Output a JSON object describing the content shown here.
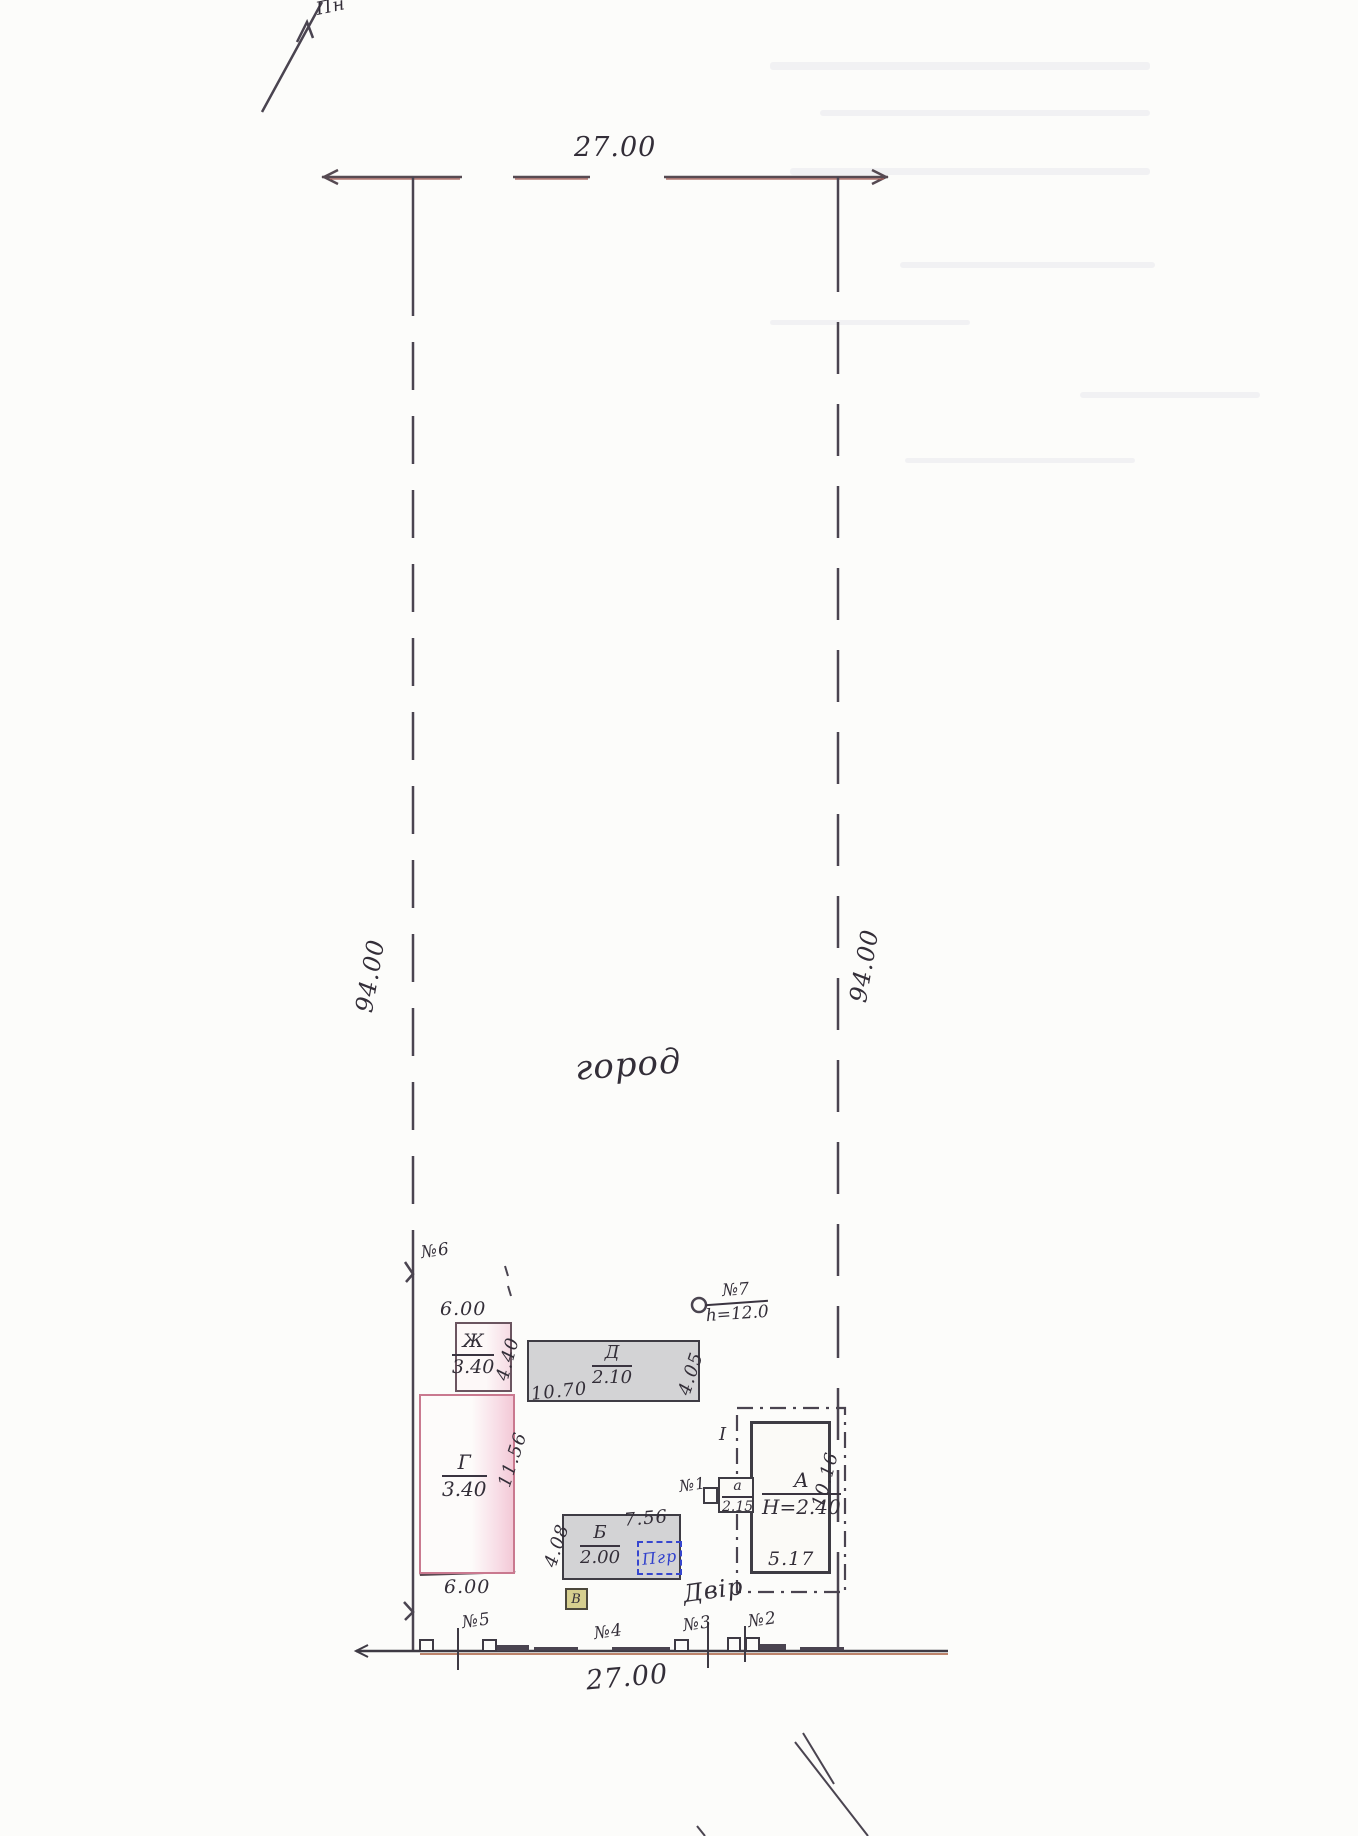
{
  "plan": {
    "north_label": "Пн",
    "garden_label": "город",
    "yard_label": "Двір",
    "dim_top": "27.00",
    "dim_bottom": "27.00",
    "dim_left": "94.00",
    "dim_right": "94.00"
  },
  "buildings": {
    "zh": {
      "letter": "Ж",
      "mark": "3.40",
      "dim_top": "6.00",
      "dim_side": "4.40"
    },
    "g": {
      "letter": "Г",
      "mark": "3.40",
      "dim_side": "11.56",
      "dim_bottom": "6.00"
    },
    "d": {
      "letter": "Д",
      "mark": "2.10",
      "dim_bottom": "10.70",
      "dim_side": "4.05"
    },
    "b": {
      "letter": "Б",
      "mark": "2.00",
      "dim_top": "7.56",
      "dim_side": "4.08",
      "cellar_label": "Пгр"
    },
    "a_main": {
      "letter": "А",
      "mark": "Н=2.40",
      "dim_bottom": "5.17",
      "dim_side": "10.16",
      "roman": "І"
    },
    "a_annex": {
      "letter": "а",
      "mark": "2.15"
    },
    "v_small": {
      "letter": "В"
    }
  },
  "markers": {
    "m1": "№1",
    "m2": "№2",
    "m3": "№3",
    "m4": "№4",
    "m5": "№5",
    "m6": "№6",
    "m7": "№7",
    "m7_height": "h=12.0"
  },
  "colors": {
    "ink": "#4a4450",
    "dim_red": "#9e5550",
    "pink_fill": "#f5cdd9",
    "gray_fill": "#d3d3d5",
    "cellar_blue": "#3646cf",
    "v_yellow": "#d6cf8f"
  }
}
